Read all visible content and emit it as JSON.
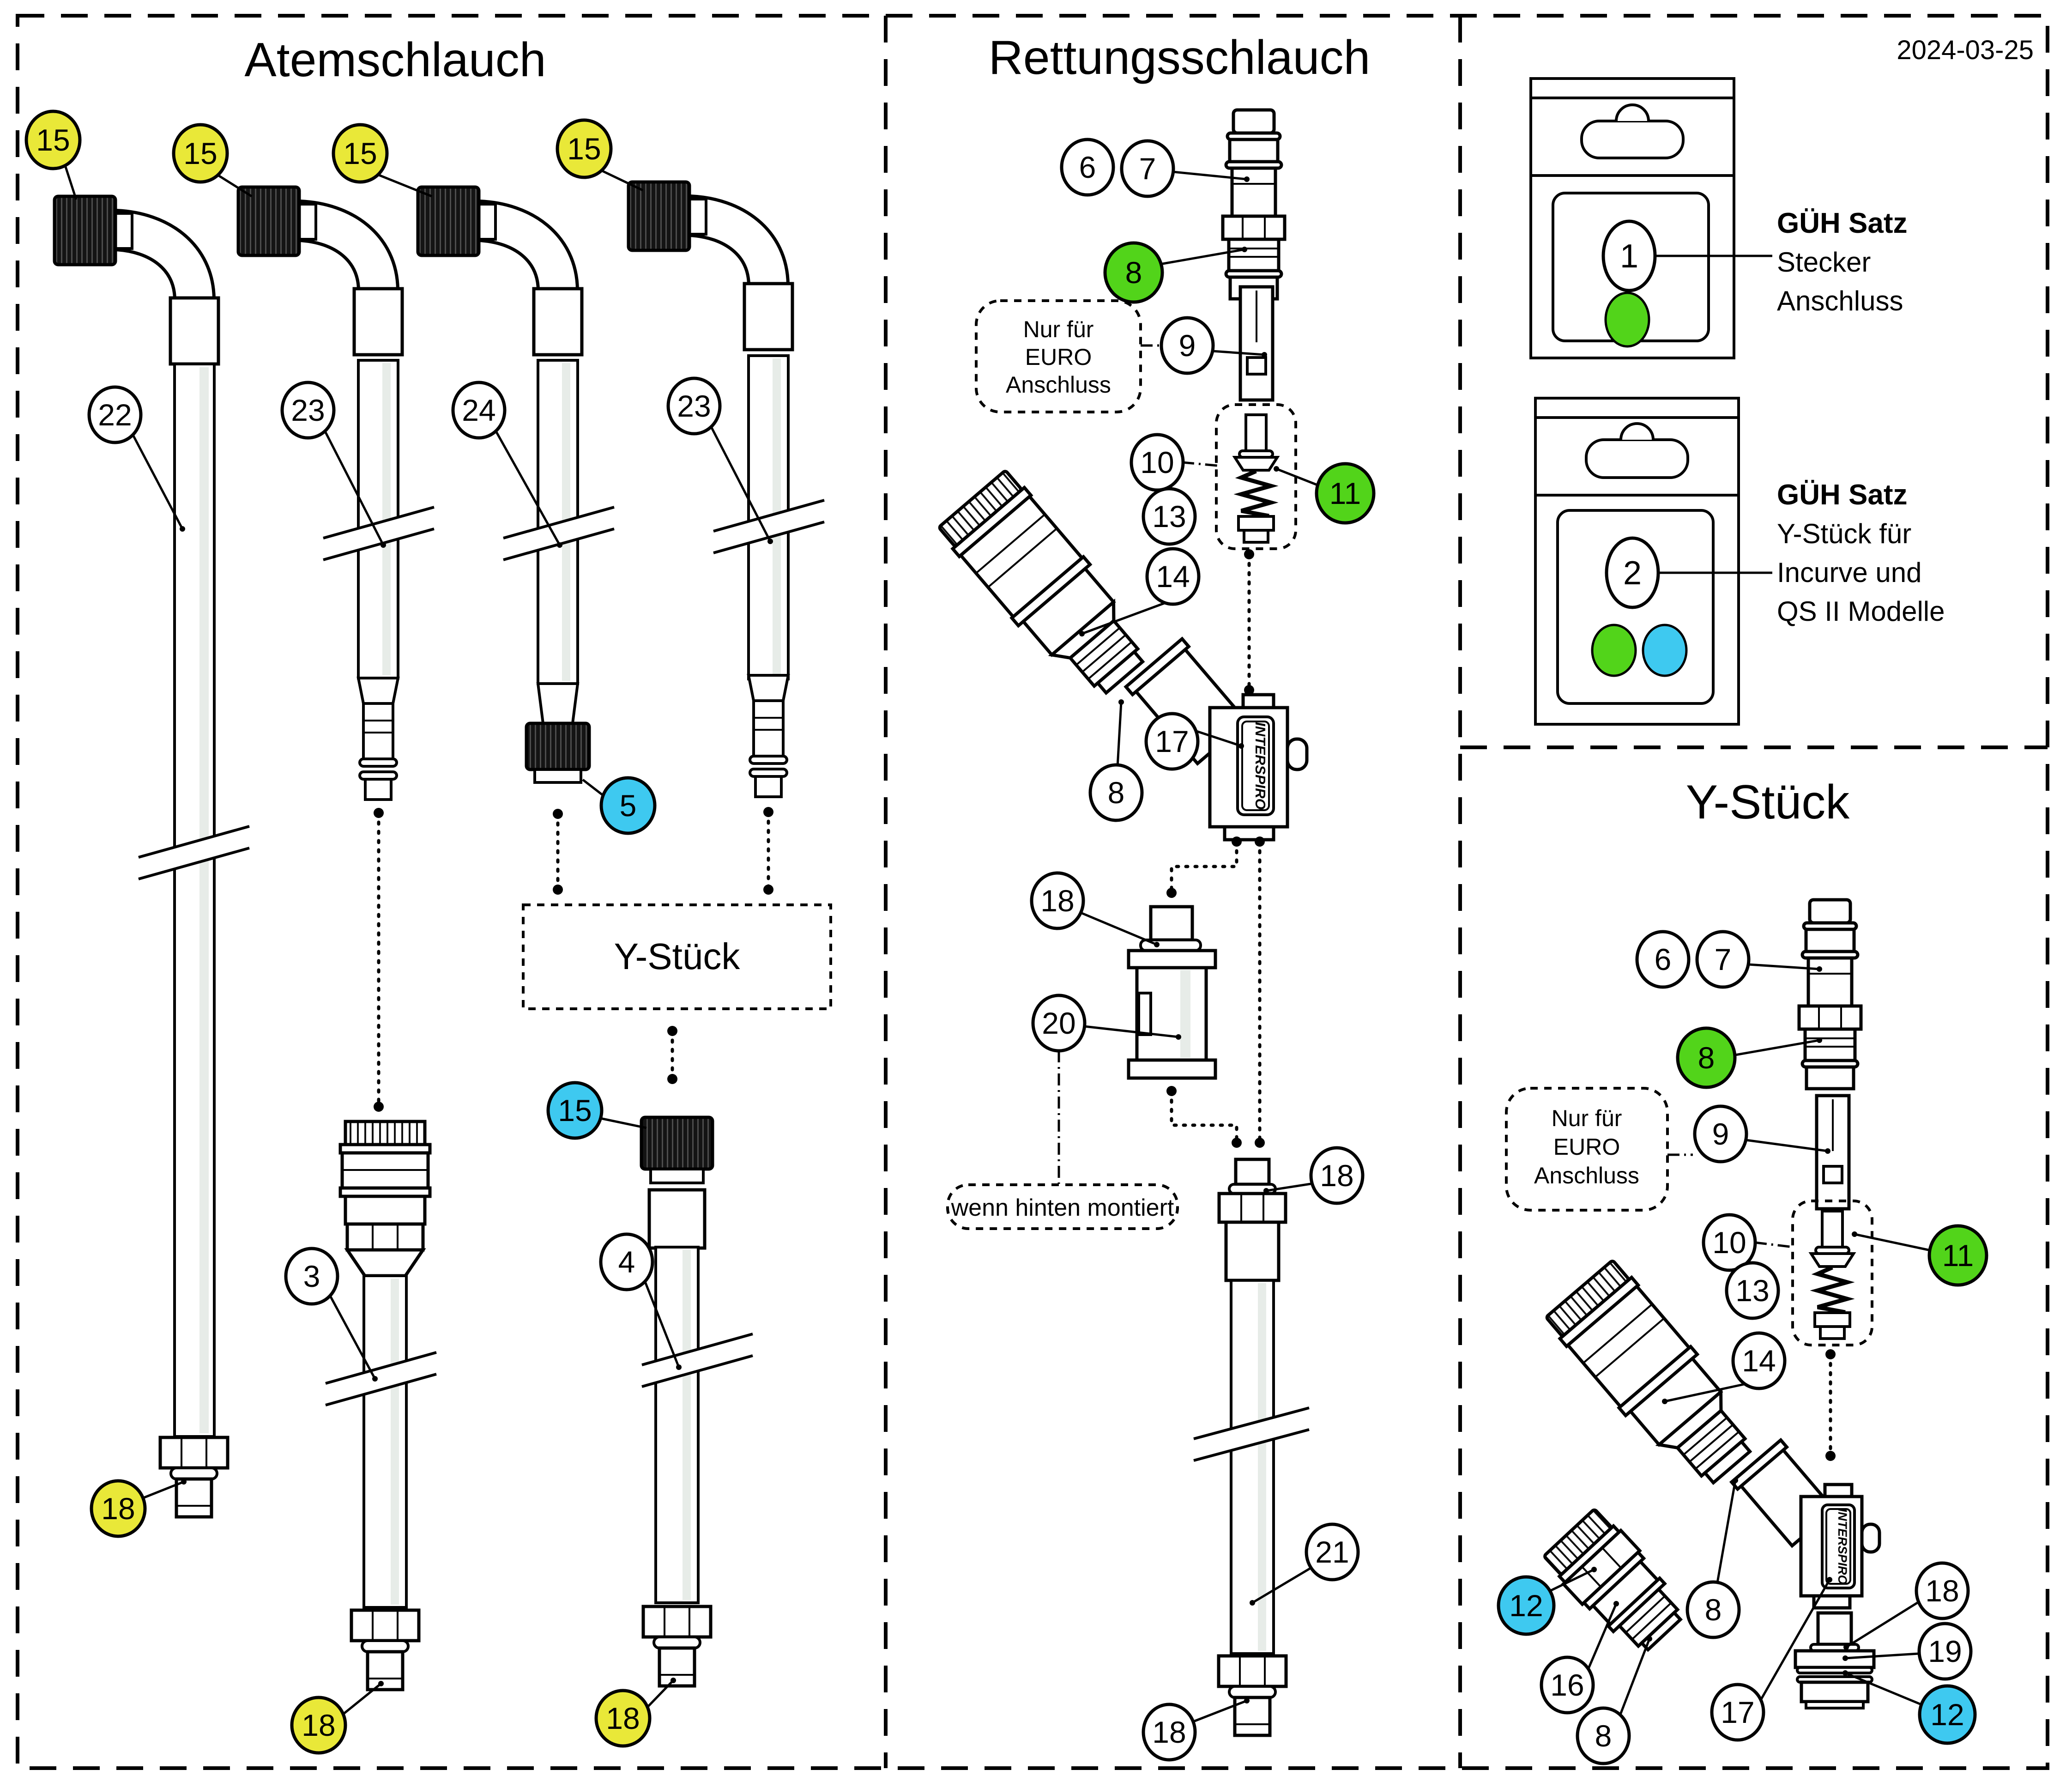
{
  "date": "2024-03-25",
  "colors": {
    "yellow": "#E9E838",
    "green": "#52D41A",
    "cyan": "#3EC9F0",
    "white": "#FFFFFF",
    "line": "#000000"
  },
  "sections": {
    "left": {
      "title": "Atemschlauch"
    },
    "middle": {
      "title": "Rettungsschlauch"
    },
    "right_bottom": {
      "title": "Y-Stück"
    }
  },
  "notes": {
    "y_box": "Y-Stück",
    "euro_line1": "Nur für",
    "euro_line2": "EURO",
    "euro_line3": "Anschluss",
    "rear_mount": "wenn hinten montiert",
    "brand": "INTERSPIRO"
  },
  "packages": [
    {
      "number": "1",
      "title": "GÜH Satz",
      "line1": "Stecker",
      "line2": "Anschluss"
    },
    {
      "number": "2",
      "title": "GÜH Satz",
      "line1": "Y-Stück für",
      "line2": "Incurve und",
      "line3": "QS II Modelle"
    }
  ],
  "callouts": {
    "a15_1": {
      "label": "15",
      "fill": "#E9E838"
    },
    "a15_2": {
      "label": "15",
      "fill": "#E9E838"
    },
    "a15_3": {
      "label": "15",
      "fill": "#E9E838"
    },
    "a15_4": {
      "label": "15",
      "fill": "#E9E838"
    },
    "a22": {
      "label": "22",
      "fill": "#FFFFFF"
    },
    "a23a": {
      "label": "23",
      "fill": "#FFFFFF"
    },
    "a24": {
      "label": "24",
      "fill": "#FFFFFF"
    },
    "a23b": {
      "label": "23",
      "fill": "#FFFFFF"
    },
    "a5": {
      "label": "5",
      "fill": "#3EC9F0"
    },
    "a15_5": {
      "label": "15",
      "fill": "#3EC9F0"
    },
    "a3": {
      "label": "3",
      "fill": "#FFFFFF"
    },
    "a4": {
      "label": "4",
      "fill": "#FFFFFF"
    },
    "a18_1": {
      "label": "18",
      "fill": "#E9E838"
    },
    "a18_2": {
      "label": "18",
      "fill": "#E9E838"
    },
    "a18_3": {
      "label": "18",
      "fill": "#E9E838"
    },
    "r6": {
      "label": "6",
      "fill": "#FFFFFF"
    },
    "r7": {
      "label": "7",
      "fill": "#FFFFFF"
    },
    "r8": {
      "label": "8",
      "fill": "#52D41A"
    },
    "r9": {
      "label": "9",
      "fill": "#FFFFFF"
    },
    "r10": {
      "label": "10",
      "fill": "#FFFFFF"
    },
    "r11": {
      "label": "11",
      "fill": "#52D41A"
    },
    "r13": {
      "label": "13",
      "fill": "#FFFFFF"
    },
    "r14": {
      "label": "14",
      "fill": "#FFFFFF"
    },
    "r8b": {
      "label": "8",
      "fill": "#FFFFFF"
    },
    "r17": {
      "label": "17",
      "fill": "#FFFFFF"
    },
    "r18a": {
      "label": "18",
      "fill": "#FFFFFF"
    },
    "r20": {
      "label": "20",
      "fill": "#FFFFFF"
    },
    "r18b": {
      "label": "18",
      "fill": "#FFFFFF"
    },
    "r21": {
      "label": "21",
      "fill": "#FFFFFF"
    },
    "r18c": {
      "label": "18",
      "fill": "#FFFFFF"
    },
    "y6": {
      "label": "6",
      "fill": "#FFFFFF"
    },
    "y7": {
      "label": "7",
      "fill": "#FFFFFF"
    },
    "y8": {
      "label": "8",
      "fill": "#52D41A"
    },
    "y9": {
      "label": "9",
      "fill": "#FFFFFF"
    },
    "y10": {
      "label": "10",
      "fill": "#FFFFFF"
    },
    "y11": {
      "label": "11",
      "fill": "#52D41A"
    },
    "y13": {
      "label": "13",
      "fill": "#FFFFFF"
    },
    "y14": {
      "label": "14",
      "fill": "#FFFFFF"
    },
    "y12a": {
      "label": "12",
      "fill": "#3EC9F0"
    },
    "y16": {
      "label": "16",
      "fill": "#FFFFFF"
    },
    "y8b": {
      "label": "8",
      "fill": "#FFFFFF"
    },
    "y8c": {
      "label": "8",
      "fill": "#FFFFFF"
    },
    "y17": {
      "label": "17",
      "fill": "#FFFFFF"
    },
    "y18": {
      "label": "18",
      "fill": "#FFFFFF"
    },
    "y19": {
      "label": "19",
      "fill": "#FFFFFF"
    },
    "y12b": {
      "label": "12",
      "fill": "#3EC9F0"
    },
    "p1": {
      "label": "1",
      "fill": "#FFFFFF"
    },
    "p2": {
      "label": "2",
      "fill": "#FFFFFF"
    }
  }
}
